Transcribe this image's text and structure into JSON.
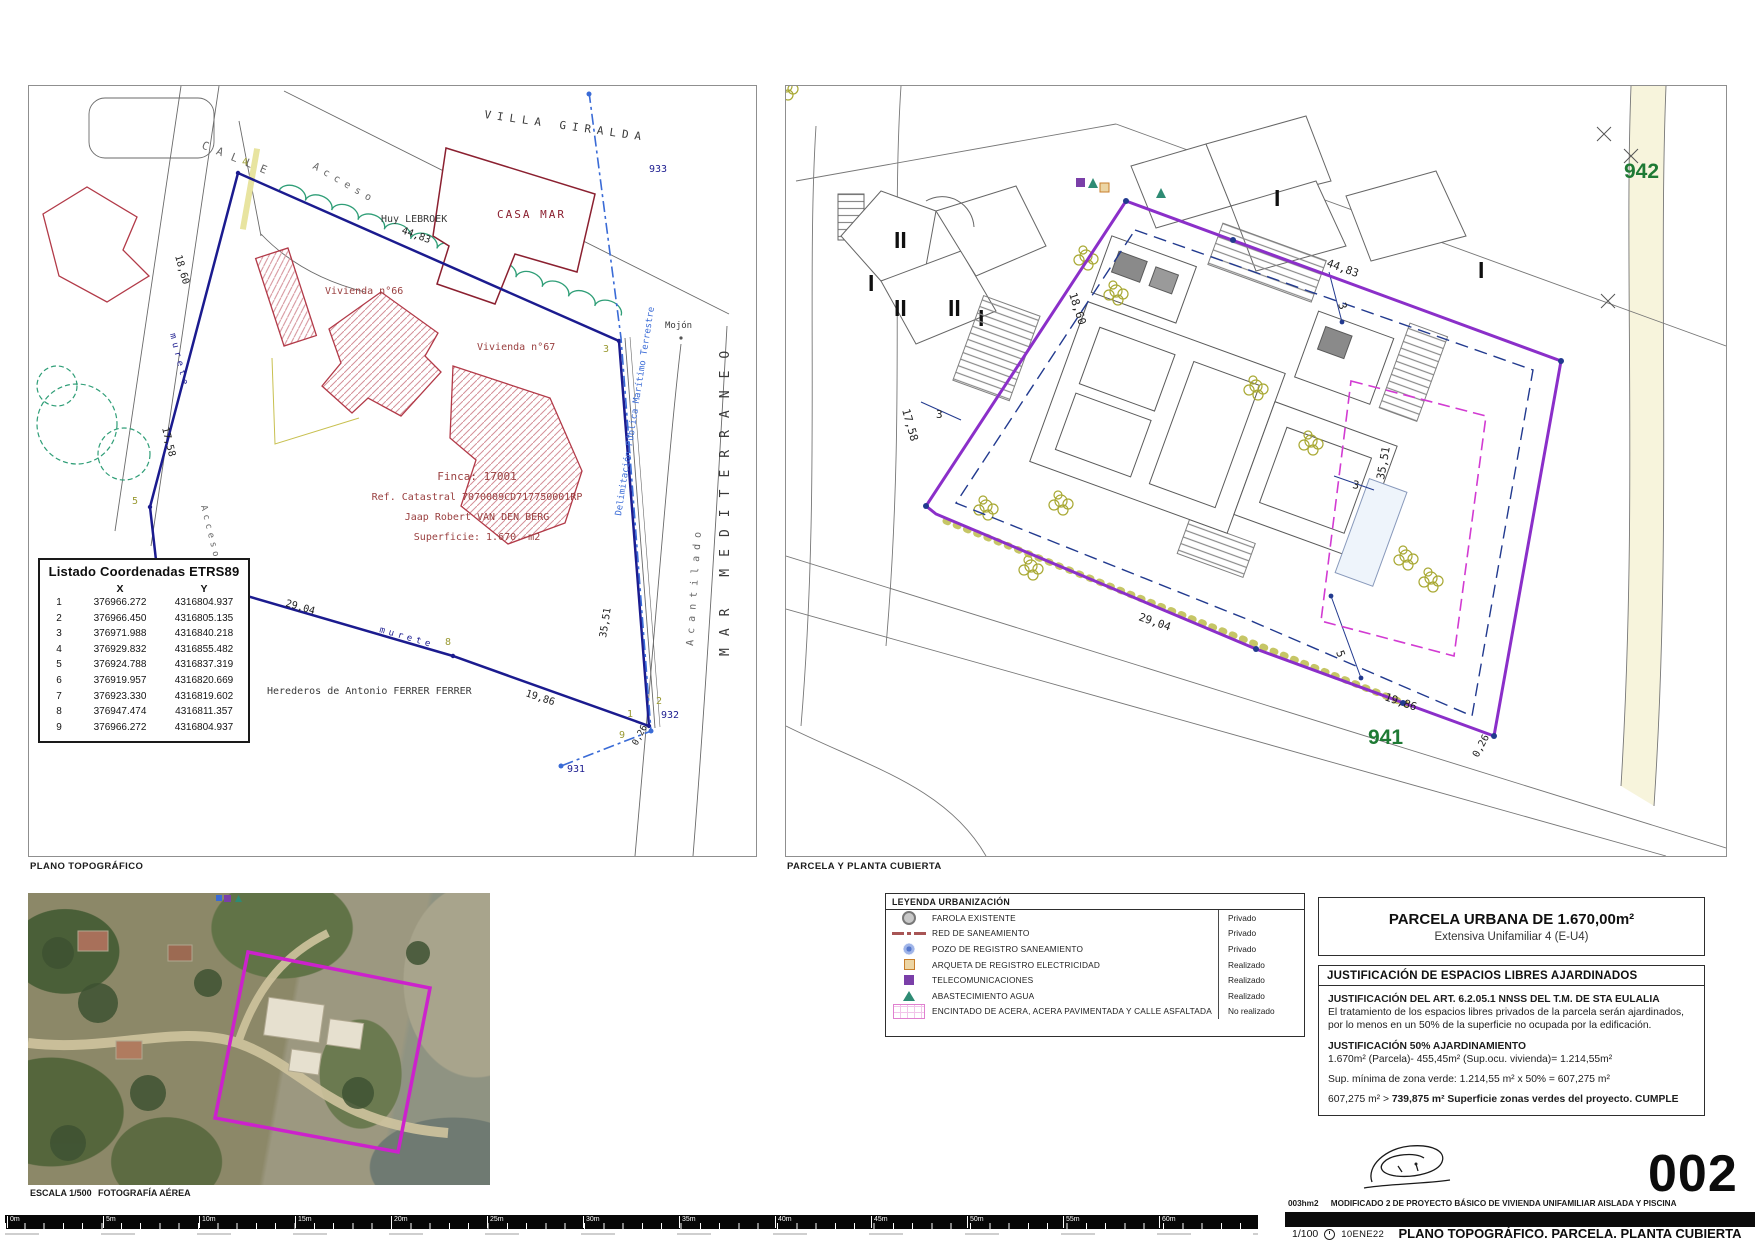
{
  "left_plan": {
    "caption": "PLANO TOPOGRÁFICO",
    "street": {
      "calle": "CALLE",
      "acceso_top": "Acceso",
      "acceso_left": "Acceso"
    },
    "labels": {
      "villa_giralda": "VILLA GIRALDA",
      "casa_mar": "CASA MAR",
      "huy_lebroek": "Huy LEBROEK",
      "vivienda_66": "Vivienda n°66",
      "vivienda_67": "Vivienda n°67",
      "mar_mediterraneo": "MAR MEDITERRANEO",
      "acantilado": "Acantilado",
      "mojon": "Mojón",
      "murete_left": "murete",
      "murete_bottom": "murete",
      "herederos": "Herederos de Antonio FERRER FERRER",
      "dpmt": "Delimitación Pública Marítimo Terrestre"
    },
    "finca_block": {
      "finca": "Finca: 17001",
      "ref_catastral": "Ref. Catastral 7070009CD717750001RP",
      "propietario": "Jaap Robert VAN DEN BERG",
      "superficie": "Superficie: 1.670.-m2"
    },
    "dims": {
      "d4483": "44,83",
      "d1860": "18,60",
      "d1758": "17,58",
      "d2904": "29,04",
      "d1986": "19,86",
      "d3551": "35,51",
      "d026": "0,26"
    },
    "hitos": {
      "h931": "931",
      "h932": "932",
      "h933": "933"
    },
    "vertices": [
      "1",
      "2",
      "3",
      "4",
      "5",
      "6",
      "7",
      "8",
      "9"
    ],
    "table": {
      "title": "Listado Coordenadas ETRS89",
      "col_x": "X",
      "col_y": "Y",
      "rows": [
        {
          "n": "1",
          "x": "376966.272",
          "y": "4316804.937"
        },
        {
          "n": "2",
          "x": "376966.450",
          "y": "4316805.135"
        },
        {
          "n": "3",
          "x": "376971.988",
          "y": "4316840.218"
        },
        {
          "n": "4",
          "x": "376929.832",
          "y": "4316855.482"
        },
        {
          "n": "5",
          "x": "376924.788",
          "y": "4316837.319"
        },
        {
          "n": "6",
          "x": "376919.957",
          "y": "4316820.669"
        },
        {
          "n": "7",
          "x": "376923.330",
          "y": "4316819.602"
        },
        {
          "n": "8",
          "x": "376947.474",
          "y": "4316811.357"
        },
        {
          "n": "9",
          "x": "376966.272",
          "y": "4316804.937"
        }
      ]
    }
  },
  "right_plan": {
    "caption": "PARCELA Y PLANTA CUBIERTA",
    "zones": {
      "z942": "942",
      "z941": "941"
    },
    "dims": {
      "d4483": "44,83",
      "d1860": "18,60",
      "d1758": "17,58",
      "d2904": "29,04",
      "d1986": "19,86",
      "d3551": "35,51",
      "d026": "0,26"
    },
    "setbacks": {
      "top": "3",
      "left": "3",
      "right": "3",
      "five": "5"
    },
    "romans": [
      "II",
      "I",
      "II",
      "II",
      "I",
      "I",
      "I"
    ]
  },
  "aerial": {
    "scale_label": "ESCALA 1/500",
    "caption": "FOTOGRAFÍA AÉREA"
  },
  "legend": {
    "title": "LEYENDA URBANIZACIÓN",
    "items": [
      {
        "label": "FAROLA EXISTENTE",
        "status": "Privado"
      },
      {
        "label": "RED DE SANEAMIENTO",
        "status": "Privado"
      },
      {
        "label": "POZO DE REGISTRO SANEAMIENTO",
        "status": "Privado"
      },
      {
        "label": "ARQUETA DE REGISTRO ELECTRICIDAD",
        "status": "Realizado"
      },
      {
        "label": "TELECOMUNICACIONES",
        "status": "Realizado"
      },
      {
        "label": "ABASTECIMIENTO AGUA",
        "status": "Realizado"
      },
      {
        "label": "ENCINTADO DE ACERA, ACERA PAVIMENTADA Y CALLE ASFALTADA",
        "status": "No realizado"
      }
    ]
  },
  "parcel_box": {
    "title": "PARCELA URBANA DE 1.670,00m²",
    "subtitle": "Extensiva Unifamiliar 4 (E-U4)"
  },
  "justification": {
    "header": "JUSTIFICACIÓN DE ESPACIOS LIBRES AJARDINADOS",
    "art_title": "JUSTIFICACIÓN DEL ART. 6.2.05.1 NNSS DEL T.M. DE STA EULALIA",
    "art_body": "El tratamiento de los espacios libres privados de la parcela serán ajardinados, por lo menos en un 50% de la superficie no ocupada por la edificación.",
    "calc_title": "JUSTIFICACIÓN 50% AJARDINAMIENTO",
    "calc_line1": "1.670m² (Parcela)- 455,45m² (Sup.ocu. vivienda)= 1.214,55m²",
    "calc_line2": "Sup. mínima de zona verde:  1.214,55 m² x 50% = 607,275 m²",
    "calc_line3_normal": "607,275 m² > ",
    "calc_line3_bold": "739,875 m² Superficie zonas verdes del proyecto. CUMPLE"
  },
  "title_block": {
    "code": "003hm2",
    "project": "MODIFICADO 2 DE PROYECTO BÁSICO DE VIVIENDA UNIFAMILIAR AISLADA Y PISCINA",
    "sheet_number": "002",
    "scale": "1/100",
    "date": "10ENE22",
    "sheet_title": "PLANO TOPOGRÁFICO. PARCELA. PLANTA CUBIERTA"
  },
  "scale_bar": {
    "labels": [
      "0m",
      "5m",
      "10m",
      "15m",
      "20m",
      "25m",
      "30m",
      "35m",
      "40m",
      "45m",
      "50m",
      "55m",
      "60m"
    ]
  },
  "colors": {
    "boundary_navy": "#1b1b8f",
    "boundary_purple": "#8b2fc9",
    "dpmt_blue": "#3a6bd6",
    "zone_green": "#1e7a34",
    "building_red": "#b23a48",
    "hedge_green": "#2f9e77",
    "magenta": "#cc33cc",
    "olive": "#9a9a33"
  }
}
